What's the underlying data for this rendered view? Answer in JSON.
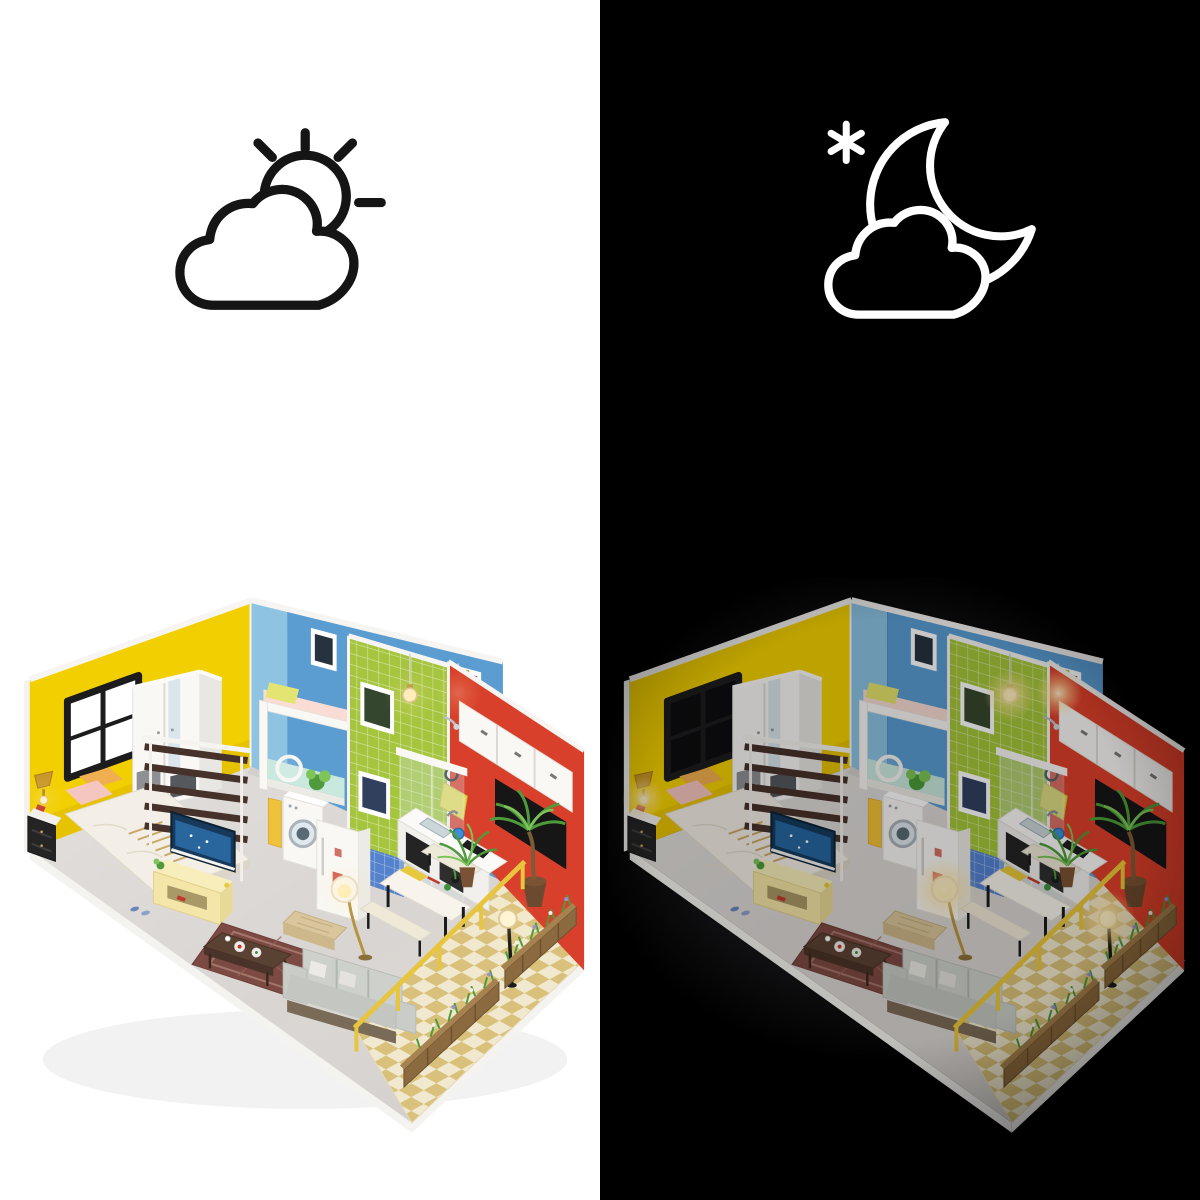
{
  "title": "DIY miniature dollhouse day and night comparison photo",
  "panels": [
    {
      "id": "day-panel",
      "scene_label": "day",
      "background": "#ffffff",
      "icon": "sun-behind-cloud-icon",
      "icon_stroke": "#151515",
      "window_pane": "#ffffff",
      "lamp_glow_opacity": 0.22,
      "house_brightness": 1,
      "house_saturation": 1
    },
    {
      "id": "night-panel",
      "scene_label": "night",
      "background": "#000000",
      "icon": "moon-star-cloud-icon",
      "icon_stroke": "#ffffff",
      "window_pane": "#0d0d0f",
      "lamp_glow_opacity": 1,
      "house_brightness": 0.78,
      "house_saturation": 1.05
    }
  ],
  "house_colors": {
    "platform_white": "#f5f3f0",
    "floor_grey": "#d9d5d2",
    "yellow_wall": "#f2cf00",
    "blue_wall": "#5b9cd1",
    "blue_wall_light": "#8ec3e2",
    "green_tile": "#a6c53e",
    "green_tile_dark": "#90b12d",
    "red_wall": "#d8402c",
    "window_frame": "#1c1c1c",
    "furniture_white": "#f9f8f5",
    "wardrobe_side": "#e9e7e3",
    "divider_wood": "#46322a",
    "duvet_white": "#f3efe6",
    "pillow_pink": "#f5c6c0",
    "pillow_orange": "#f0b052",
    "loft_mattress_pink": "#f9dcd4",
    "loft_pillow_yellow": "#e4e472",
    "bunk_teal": "#c9e9de",
    "tv_stand_yellow": "#f3e6a8",
    "tv_screen_blue": "#2d6fa8",
    "sofa_grey": "#cdd0cb",
    "rug_maroon": "#7c4a42",
    "coffee_table_brown": "#5a4233",
    "ottoman_tan": "#d9c69c",
    "counter_door_black": "#242424",
    "hood_black": "#161616",
    "towel_yellow": "#e6d95c",
    "kettle_blue": "#3f8fd2",
    "bath_tile_blue": "#5582cd",
    "patio_cream": "#f1e9cf",
    "patio_tan": "#d9c17c",
    "railing_yellow": "#e8c53e",
    "planter_wood": "#8c6a3f",
    "leaf_green": "#4e9a3c",
    "leaf_light": "#7fc45a",
    "flower_purple": "#9b8fd8",
    "lamp_gold": "#c9972c",
    "glow_warm": "#ffe9b0"
  }
}
